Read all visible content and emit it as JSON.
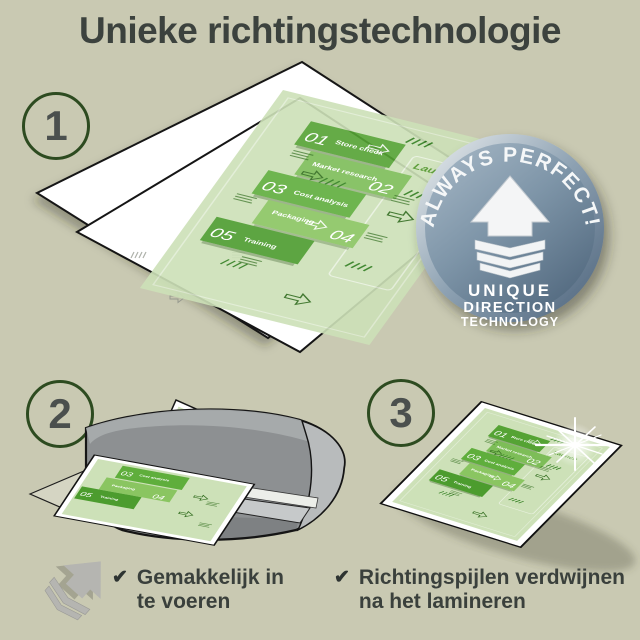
{
  "title": "Unieke richtingstechnologie",
  "step_labels": {
    "step1": "1",
    "step2": "2",
    "step3": "3"
  },
  "badge": {
    "arc_text": "ALWAYS PERFECT!",
    "line1": "UNIQUE",
    "line2": "DIRECTION",
    "line3": "TECHNOLOGY"
  },
  "document": {
    "launch_label": "Launch",
    "items": [
      {
        "num": "01",
        "label": "Store check"
      },
      {
        "num": "02",
        "label": "Market research"
      },
      {
        "num": "03",
        "label": "Cost analysis"
      },
      {
        "num": "04",
        "label": "Packaging"
      },
      {
        "num": "05",
        "label": "Training"
      }
    ]
  },
  "checklist": {
    "check_glyph": "✔",
    "item1_line1": "Gemakkelijk in",
    "item1_line2": "te voeren",
    "item2_line1": "Richtingspijlen verdwijnen",
    "item2_line2": "na het lamineren"
  },
  "colors": {
    "background": "#c9c9b2",
    "title_text": "#3c423e",
    "accent_green_dark": "#4c9c2e",
    "accent_green_mid": "#5fae3c",
    "accent_green_light": "#8ac561",
    "page_green_pale": "#cde1b8",
    "badge_blue": "#6d8499",
    "machine_gray": "#909394"
  }
}
